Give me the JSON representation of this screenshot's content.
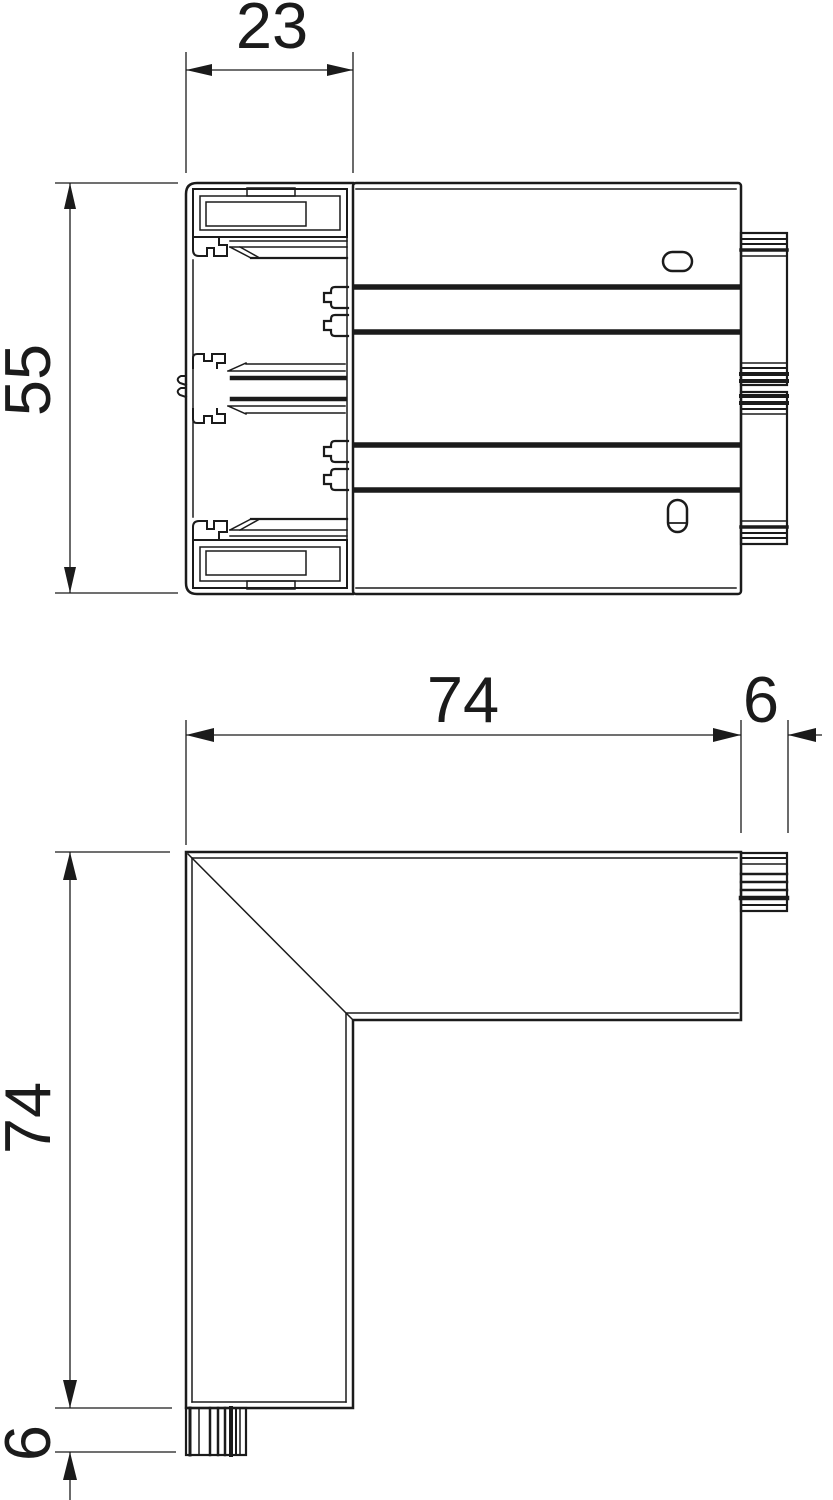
{
  "page": {
    "background": "#ffffff",
    "line_color": "#1b1b1b",
    "description": "Technical dimension drawing: trunking profile cross-section and internal corner piece"
  },
  "views": {
    "cross_section": {
      "name": "trunking-cross-section",
      "dims": {
        "width": "23",
        "height": "55"
      }
    },
    "corner": {
      "name": "corner-elbow-outline",
      "dims": {
        "horizontal_length": "74",
        "horizontal_spigot": "6",
        "vertical_length": "74",
        "vertical_spigot": "6"
      }
    }
  }
}
